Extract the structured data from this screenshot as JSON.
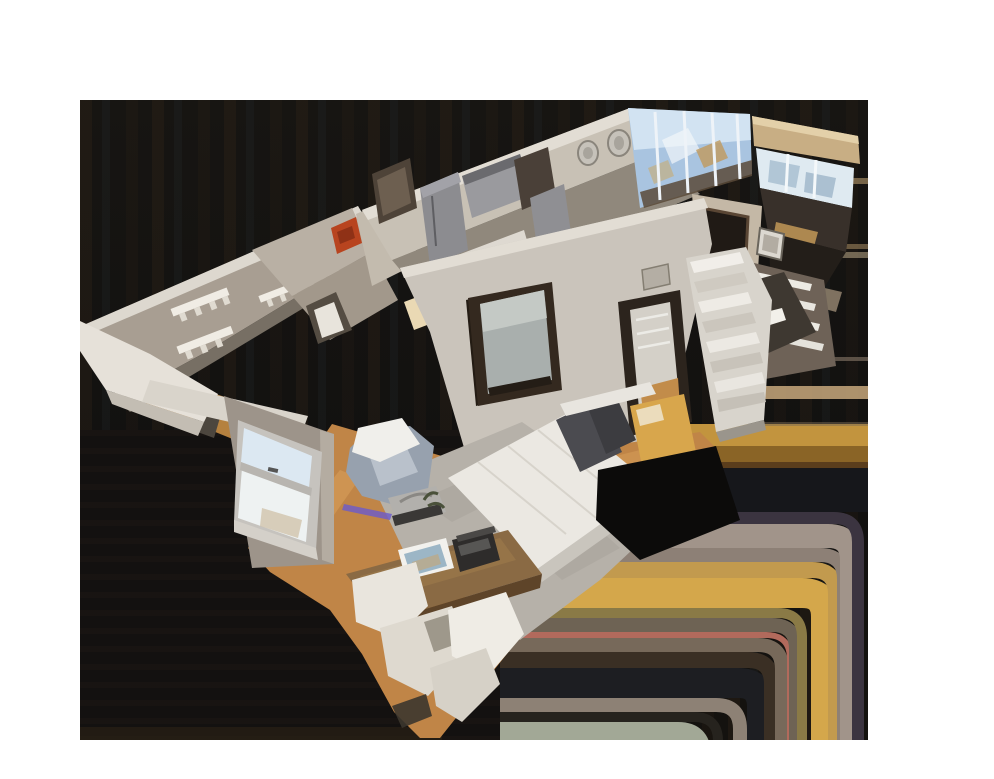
{
  "scene": {
    "kind": "3d-dollhouse-scan-view",
    "camera": "aerial-oblique",
    "background": {
      "page": "#ffffff",
      "viewport": "#141211"
    },
    "viewport_px": {
      "x": 80,
      "y": 100,
      "width": 788,
      "height": 640
    },
    "palette": {
      "wall_taupe": "#a89e92",
      "wall_light": "#c8c1b5",
      "wall_pale": "#cac4bb",
      "wall_dim": "#90887c",
      "wall_gray": "#9d948a",
      "cap_white": "#e2ddd4",
      "floor_wood": "#c08547",
      "floor_wood_light": "#e8b268",
      "rug_gray": "#b6b1a9",
      "bedding_white": "#ebe8e2",
      "pillow_charcoal": "#4b4b50",
      "sky_blue": "#a9c4e0",
      "sky_pale": "#dfeaf1",
      "soffit_tan": "#c8ae84",
      "steel_gray": "#8c8c90",
      "door_frame_dark": "#34291f",
      "accent_red": "#b8441f",
      "bench_gold": "#d8a64c",
      "smear_gold": "#d4a74b",
      "smear_salmon": "#b26a5c",
      "smear_taupe": "#a1948a",
      "smear_green": "#a2a896",
      "hole_black": "#0c0b0a"
    },
    "regions": [
      {
        "name": "entry-hall",
        "features": [
          "coat-hook-racks",
          "white-console-shelf"
        ]
      },
      {
        "name": "kitchen",
        "features": [
          "stainless-fridge",
          "wall-art",
          "round-mirrors",
          "white-island",
          "red-accent"
        ]
      },
      {
        "name": "living-corner",
        "features": [
          "floor-to-ceiling-windows",
          "tan-soffit"
        ]
      },
      {
        "name": "hallway",
        "features": [
          "mirrored-door",
          "closet-door",
          "wall-vent"
        ]
      },
      {
        "name": "stairwell",
        "features": [
          "white-open-stairs",
          "closet-shelves"
        ]
      },
      {
        "name": "bathroom",
        "features": [
          "dark-doorway",
          "towel",
          "picture-frame"
        ]
      },
      {
        "name": "bedroom",
        "features": [
          "bed",
          "pillows",
          "area-rug",
          "gold-bench",
          "sash-window",
          "armchair",
          "wood-desk",
          "white-chairs"
        ]
      }
    ]
  }
}
